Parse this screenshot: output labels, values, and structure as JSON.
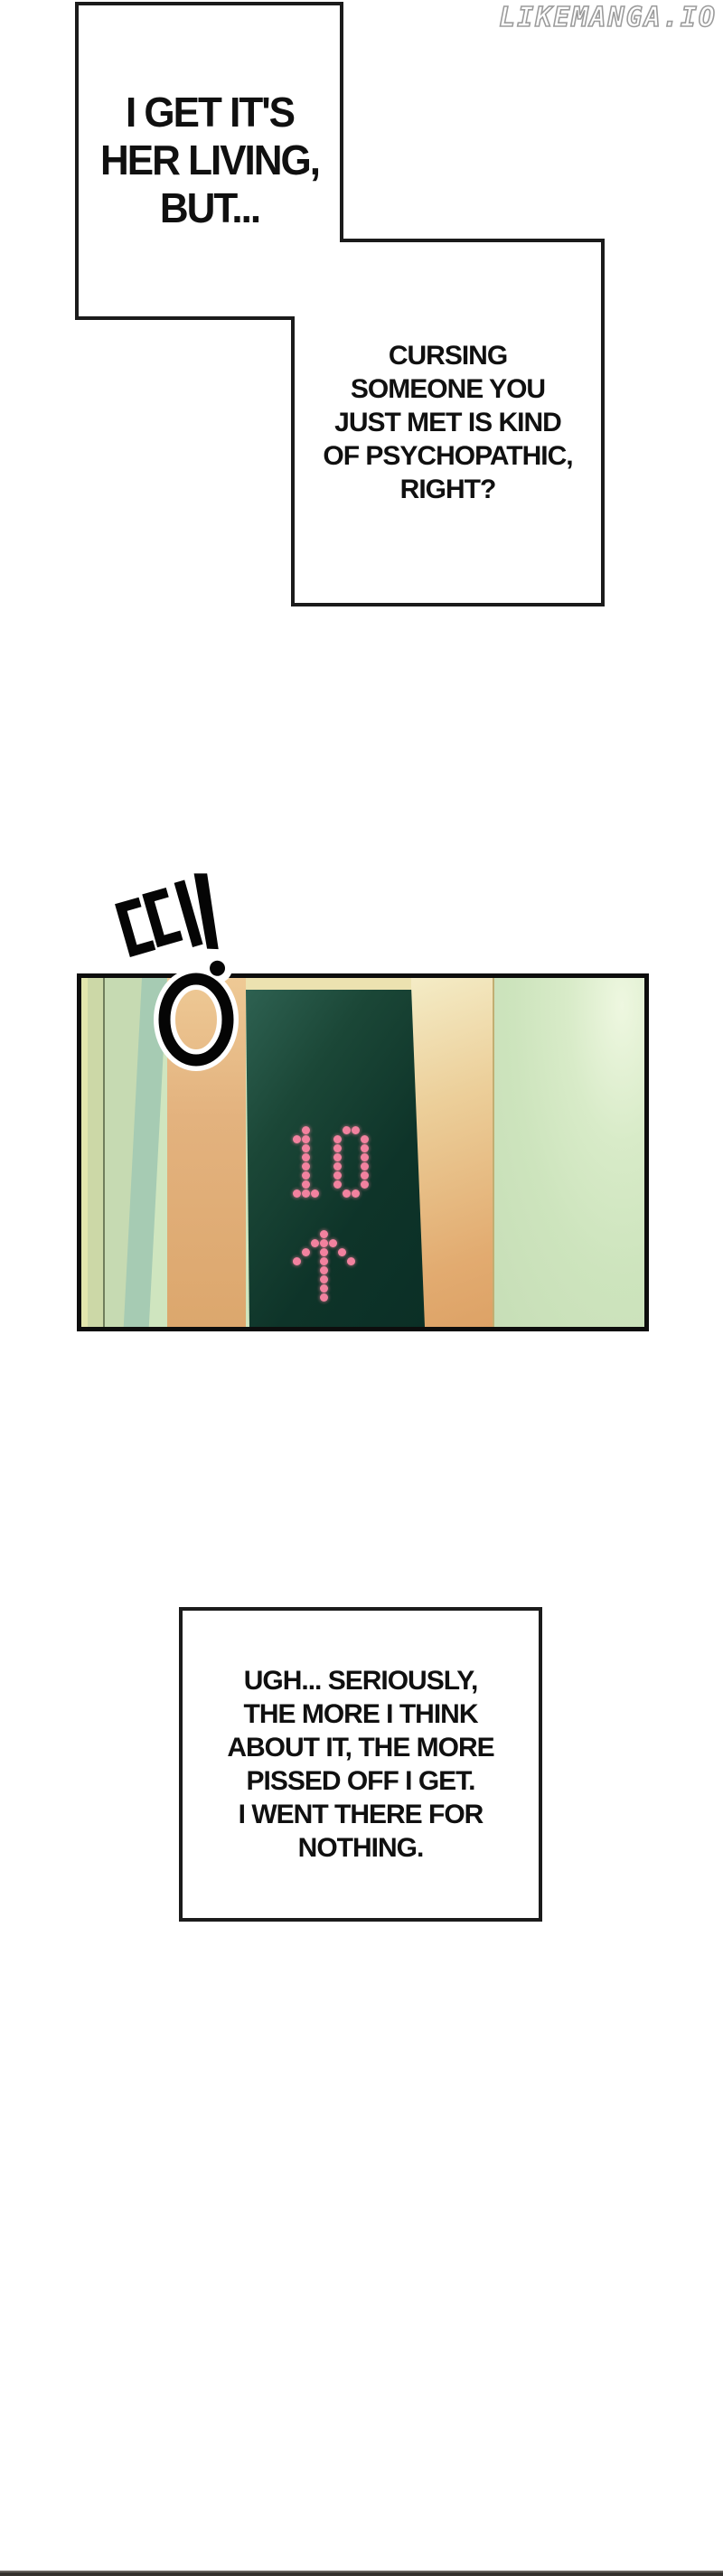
{
  "watermark": {
    "text": "LIKEMANGA.IO"
  },
  "bubbles": [
    {
      "lines": [
        "I GET IT'S",
        "HER LIVING,",
        "BUT..."
      ]
    },
    {
      "lines": [
        "CURSING",
        "SOMEONE YOU",
        "JUST MET IS KIND",
        "OF PSYCHOPATHIC,",
        "RIGHT?"
      ]
    },
    {
      "lines": [
        "UGH... SERIOUSLY,",
        "THE MORE I THINK",
        "ABOUT IT, THE MORE",
        "PISSED OFF I GET.",
        "I WENT THERE FOR",
        "NOTHING."
      ]
    }
  ],
  "sfx": {
    "text": "띵!",
    "meaning": "ding!"
  },
  "elevator_panel": {
    "floor_display": {
      "floor": "10",
      "direction": "up",
      "dot_color": "#f2829f",
      "display_background": "#0e3429"
    },
    "dot_patterns": {
      "1": [
        "..#..",
        ".##..",
        "..#..",
        "..#..",
        "..#..",
        "..#..",
        "..#..",
        ".###."
      ],
      "0": [
        ".##.",
        "#..#",
        "#..#",
        "#..#",
        "#..#",
        "#..#",
        "#..#",
        ".##."
      ],
      "arrow": [
        "...#...",
        "..###..",
        ".#.#.#.",
        "#..#..#",
        "...#...",
        "...#...",
        "...#...",
        "...#..."
      ]
    },
    "colors": {
      "left_strip_1": "#e2e6ad",
      "left_strip_2": "#ccd8a7",
      "left_strip_3": "#c6dab2",
      "left_strip_4": "#a6cbb3",
      "door_frame_orange": "#e3b27e",
      "lintel_cream": "#ece2b0",
      "right_wall_green": "#cde4bd"
    }
  },
  "footer": {
    "divider_color": "#38332f"
  }
}
